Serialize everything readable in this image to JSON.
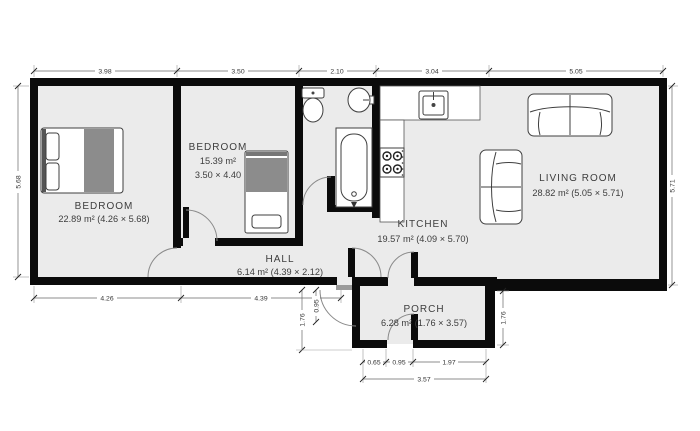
{
  "rooms": {
    "bedroom1": {
      "name": "BEDROOM",
      "area": "22.89 m² (4.26 × 5.68)"
    },
    "bedroom2": {
      "name": "BEDROOM",
      "area": "15.39 m²",
      "size": "3.50 × 4.40"
    },
    "hall": {
      "name": "HALL",
      "area": "6.14 m² (4.39 × 2.12)"
    },
    "kitchen": {
      "name": "KITCHEN",
      "area": "19.57 m² (4.09 × 5.70)"
    },
    "living_room": {
      "name": "LIVING ROOM",
      "area": "28.82 m² (5.05 × 5.71)"
    },
    "porch": {
      "name": "PORCH",
      "area": "6.28 m² (1.76 × 3.57)"
    }
  },
  "dimensions": {
    "top": {
      "d1": "3.98",
      "d2": "3.50",
      "d3": "2.10",
      "d4": "3.04",
      "d5": "5.05"
    },
    "left_height": "5.68",
    "right_height": "5.71",
    "bottom": {
      "d1": "4.26",
      "d2": "4.39"
    },
    "porch": {
      "left_height": "1.76",
      "left_door": "0.95",
      "right_height": "1.76",
      "bottom_segments": {
        "s1": "0.65",
        "s2": "0.95",
        "s3": "1.97"
      },
      "bottom_total": "3.57"
    }
  },
  "fixtures": {
    "double_bed": "double-bed",
    "single_bed": "single-bed",
    "toilet": "toilet",
    "sink": "washbasin",
    "bathtub": "bathtub",
    "kitchen_sink": "kitchen-sink",
    "stove": "stove-4-burner",
    "sofa_large": "two-seat-sofa",
    "sofa_small": "two-seat-sofa"
  },
  "colors": {
    "wall": "#0b0b0b",
    "floor": "#ebebeb",
    "furniture_gray": "#8c8c8c",
    "dim_text": "#333333"
  }
}
